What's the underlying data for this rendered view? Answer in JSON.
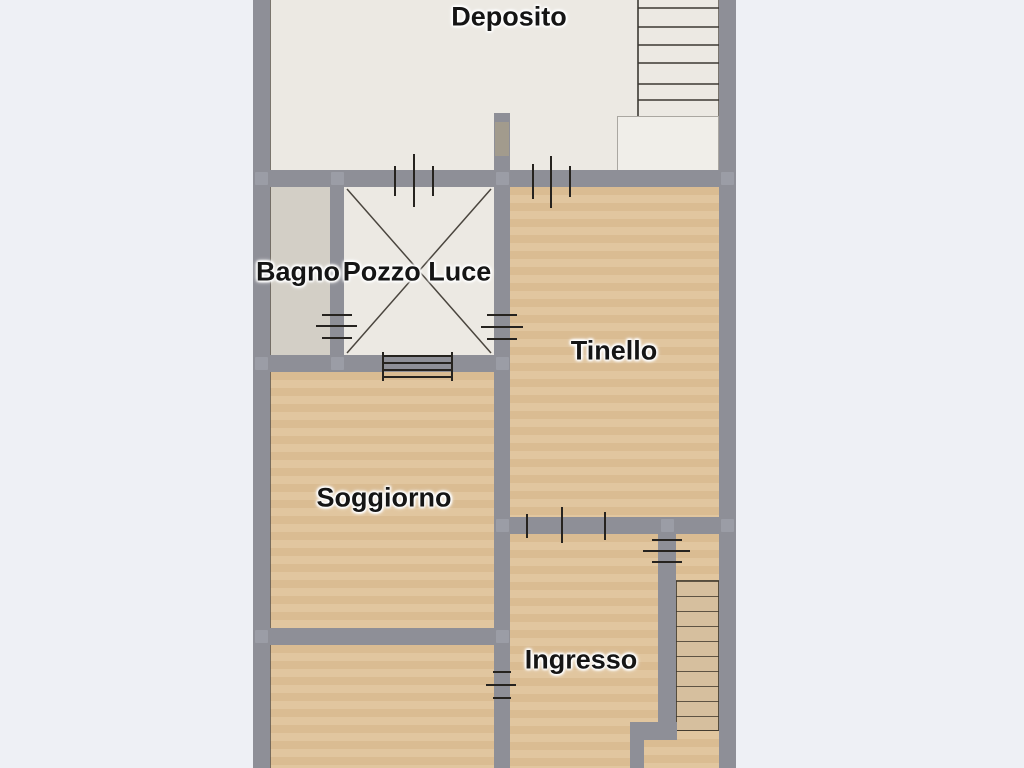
{
  "title": "Apartment floor plan",
  "rooms": {
    "deposito": {
      "label": "Deposito"
    },
    "bagno": {
      "label": "Bagno"
    },
    "pozzo_luce": {
      "label": "Pozzo Luce"
    },
    "tinello": {
      "label": "Tinello"
    },
    "soggiorno": {
      "label": "Soggiorno"
    },
    "ingresso": {
      "label": "Ingresso"
    }
  },
  "colors": {
    "background": "#eef0f5",
    "wall": "#8e8f97",
    "floor_light": "#ece9e3",
    "floor_tile": "#d3cfc6",
    "floor_wood": "#dfc299",
    "floor_steps": "#d6bf9e",
    "symbol_line": "#26231f"
  }
}
